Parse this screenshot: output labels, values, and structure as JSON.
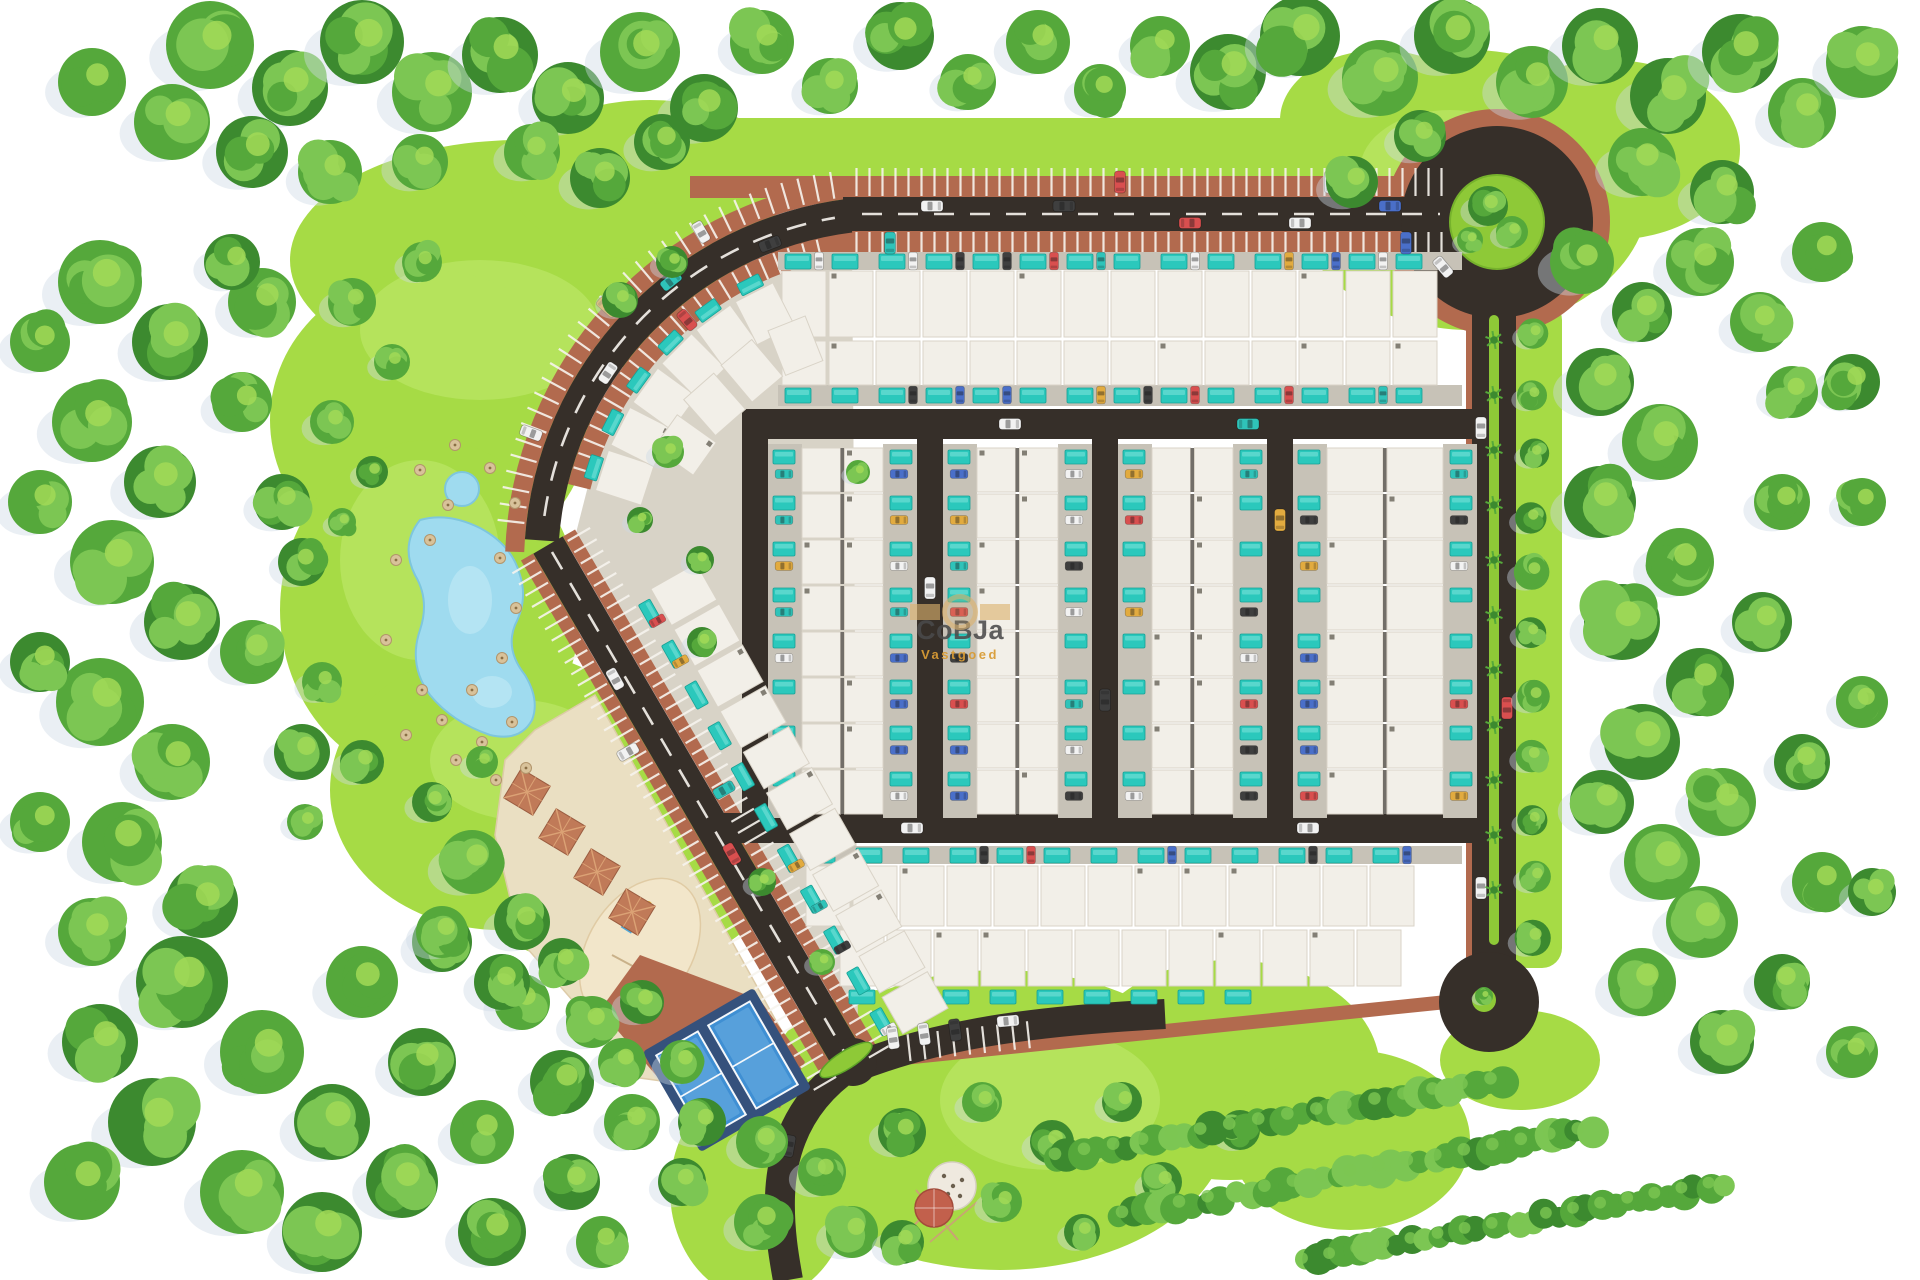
{
  "watermark": {
    "brand": "CoBJa",
    "tagline": "Vastgoed"
  },
  "palette": {
    "background": "#ffffff",
    "lawn": "#a6db45",
    "lawn_light": "#c3ec74",
    "lawn_dark": "#8cc936",
    "median_green": "#8ec937",
    "tree_dark": "#3c8a2f",
    "tree_mid": "#55a83b",
    "tree_light": "#7cc653",
    "tree_pale": "#a2d957",
    "tree_shadow": "#ccd8e4",
    "road": "#362f29",
    "road_marking": "#f7f4ee",
    "brick": "#b26a4e",
    "paving": "#d8d3c7",
    "villa_roof": "#f2efe8",
    "villa_edge": "#d9d3c7",
    "driveway": "#c7c2b7",
    "pool": "#2bc8bc",
    "pool_light": "#7fe4da",
    "lake": "#9fdbef",
    "sand": "#eadfc2",
    "sand_play": "#f2e6ca",
    "court_blue": "#3f8fd3",
    "court_light": "#6fb1e4",
    "court_deck": "#35517c",
    "pergola": "#c07a58",
    "pavilion_red": "#c2604c",
    "umbrella": "#d8c29a",
    "watermark_gold": "#d9a23f",
    "watermark_bar": "#dcb26e",
    "watermark_text": "#4f4f4f"
  },
  "car_colors": [
    "#f2f2f2",
    "#d94f4f",
    "#2fc3b9",
    "#e2ab3f",
    "#4a6fc9",
    "#3f3f3f"
  ],
  "features": [
    "perimeter-ring-road",
    "angled-parking",
    "roundabout",
    "villa-grid-with-pools",
    "lake",
    "playground",
    "padel-courts",
    "pergola-plaza",
    "tree-belt",
    "cul-de-sac",
    "entrance-drive",
    "pavilion"
  ]
}
